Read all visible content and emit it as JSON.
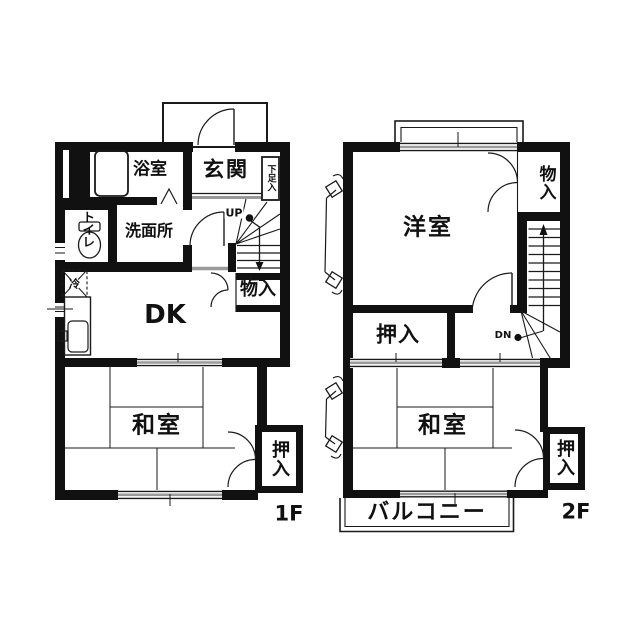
{
  "floor_plan": {
    "title": "two-story-apartment-floor-plan",
    "floor1": {
      "floor_label": "1F",
      "rooms": {
        "bath": "浴室",
        "entrance": "玄関",
        "shoe_cabinet": "下足入",
        "toilet": "トイレ",
        "washroom": "洗面所",
        "dining_kitchen": "DK",
        "storage": "物入",
        "japanese_room": "和室",
        "closet": "押入"
      },
      "stair_direction": "UP",
      "refrigerator_label": "冷"
    },
    "floor2": {
      "floor_label": "2F",
      "rooms": {
        "western_room": "洋室",
        "storage": "物入",
        "closet_left": "押入",
        "japanese_room": "和室",
        "closet_right": "押入",
        "balcony": "バルコニー"
      },
      "stair_direction": "DN"
    },
    "colors": {
      "wall": "#111111",
      "line": "#1a1a1a",
      "glass": "#9a9a9a"
    }
  }
}
